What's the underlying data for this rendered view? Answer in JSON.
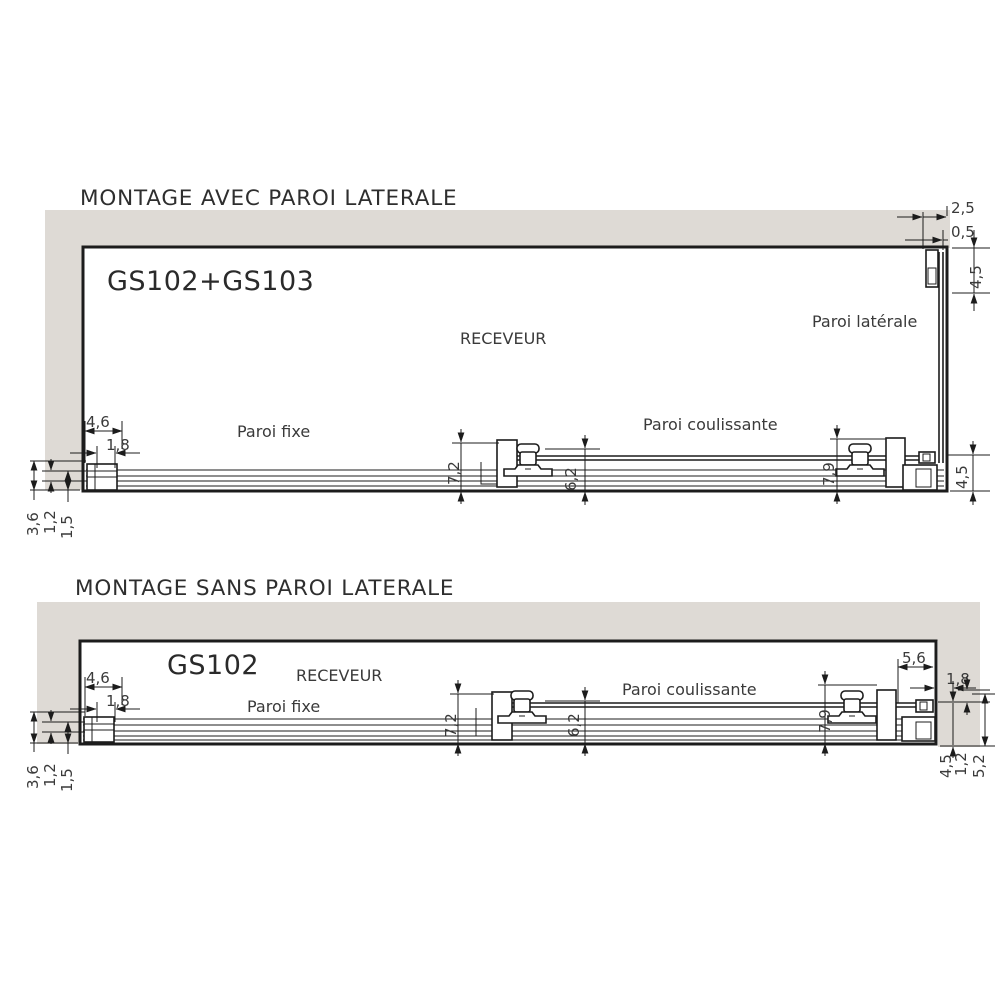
{
  "colors": {
    "bg": "#ffffff",
    "wall": "#dedad5",
    "line": "#1c1c1c",
    "text": "#3a3a3a",
    "title": "#2e2e2e"
  },
  "top": {
    "title": "MONTAGE AVEC PAROI LATERALE",
    "model": "GS102+GS103",
    "labels": {
      "receveur": "RECEVEUR",
      "paroi_laterale": "Paroi latérale",
      "paroi_fixe": "Paroi fixe",
      "paroi_coulissante": "Paroi coulissante"
    },
    "dims": {
      "d2_5": "2,5",
      "d0_5": "0,5",
      "d4_5a": "4,5",
      "d4_6": "4,6",
      "d1_8": "1,8",
      "d3_6": "3,6",
      "d1_2": "1,2",
      "d1_5": "1,5",
      "d7_2": "7,2",
      "d6_2": "6,2",
      "d7_9": "7,9",
      "d4_5b": "4,5"
    }
  },
  "bottom": {
    "title": "MONTAGE SANS PAROI LATERALE",
    "model": "GS102",
    "labels": {
      "receveur": "RECEVEUR",
      "paroi_fixe": "Paroi fixe",
      "paroi_coulissante": "Paroi coulissante"
    },
    "dims": {
      "d4_6": "4,6",
      "d1_8a": "1,8",
      "d3_6": "3,6",
      "d1_2a": "1,2",
      "d1_5": "1,5",
      "d7_2": "7,2",
      "d6_2": "6,2",
      "d7_9": "7,9",
      "d5_6": "5,6",
      "d1_8b": "1,8",
      "d4_5": "4,5",
      "d1_2b": "1,2",
      "d5_2": "5,2"
    }
  }
}
